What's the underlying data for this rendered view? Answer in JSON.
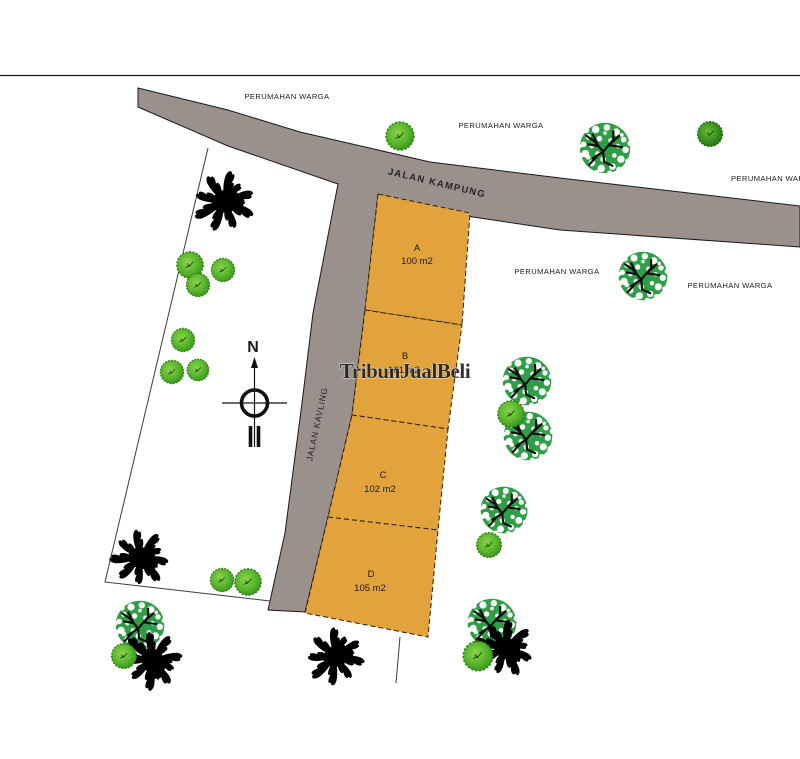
{
  "map": {
    "road_labels": {
      "kampung": "JALAN KAMPUNG",
      "kavling": "JALAN KAVLING"
    },
    "surroundings": [
      "PERUMAHAN WARGA",
      "PERUMAHAN WARGA",
      "PERUMAHAN WAF",
      "PERUMAHAN WARGA",
      "PERUMAHAN WARGA"
    ],
    "plots": [
      {
        "id": "A",
        "area": "100 m2"
      },
      {
        "id": "B",
        "area": "101 m2"
      },
      {
        "id": "C",
        "area": "102 m2"
      },
      {
        "id": "D",
        "area": "105 m2"
      }
    ],
    "compass": {
      "north_label": "N"
    },
    "watermark": {
      "text": "TribunJualBeli"
    },
    "colors": {
      "road": "#9a918c",
      "plot_fill": "#e2a33c",
      "plot_outline": "#2b2013",
      "dappled_tree": "#2f9e47",
      "palm": "#000000",
      "boundary_line": "#3c3c3c"
    }
  }
}
